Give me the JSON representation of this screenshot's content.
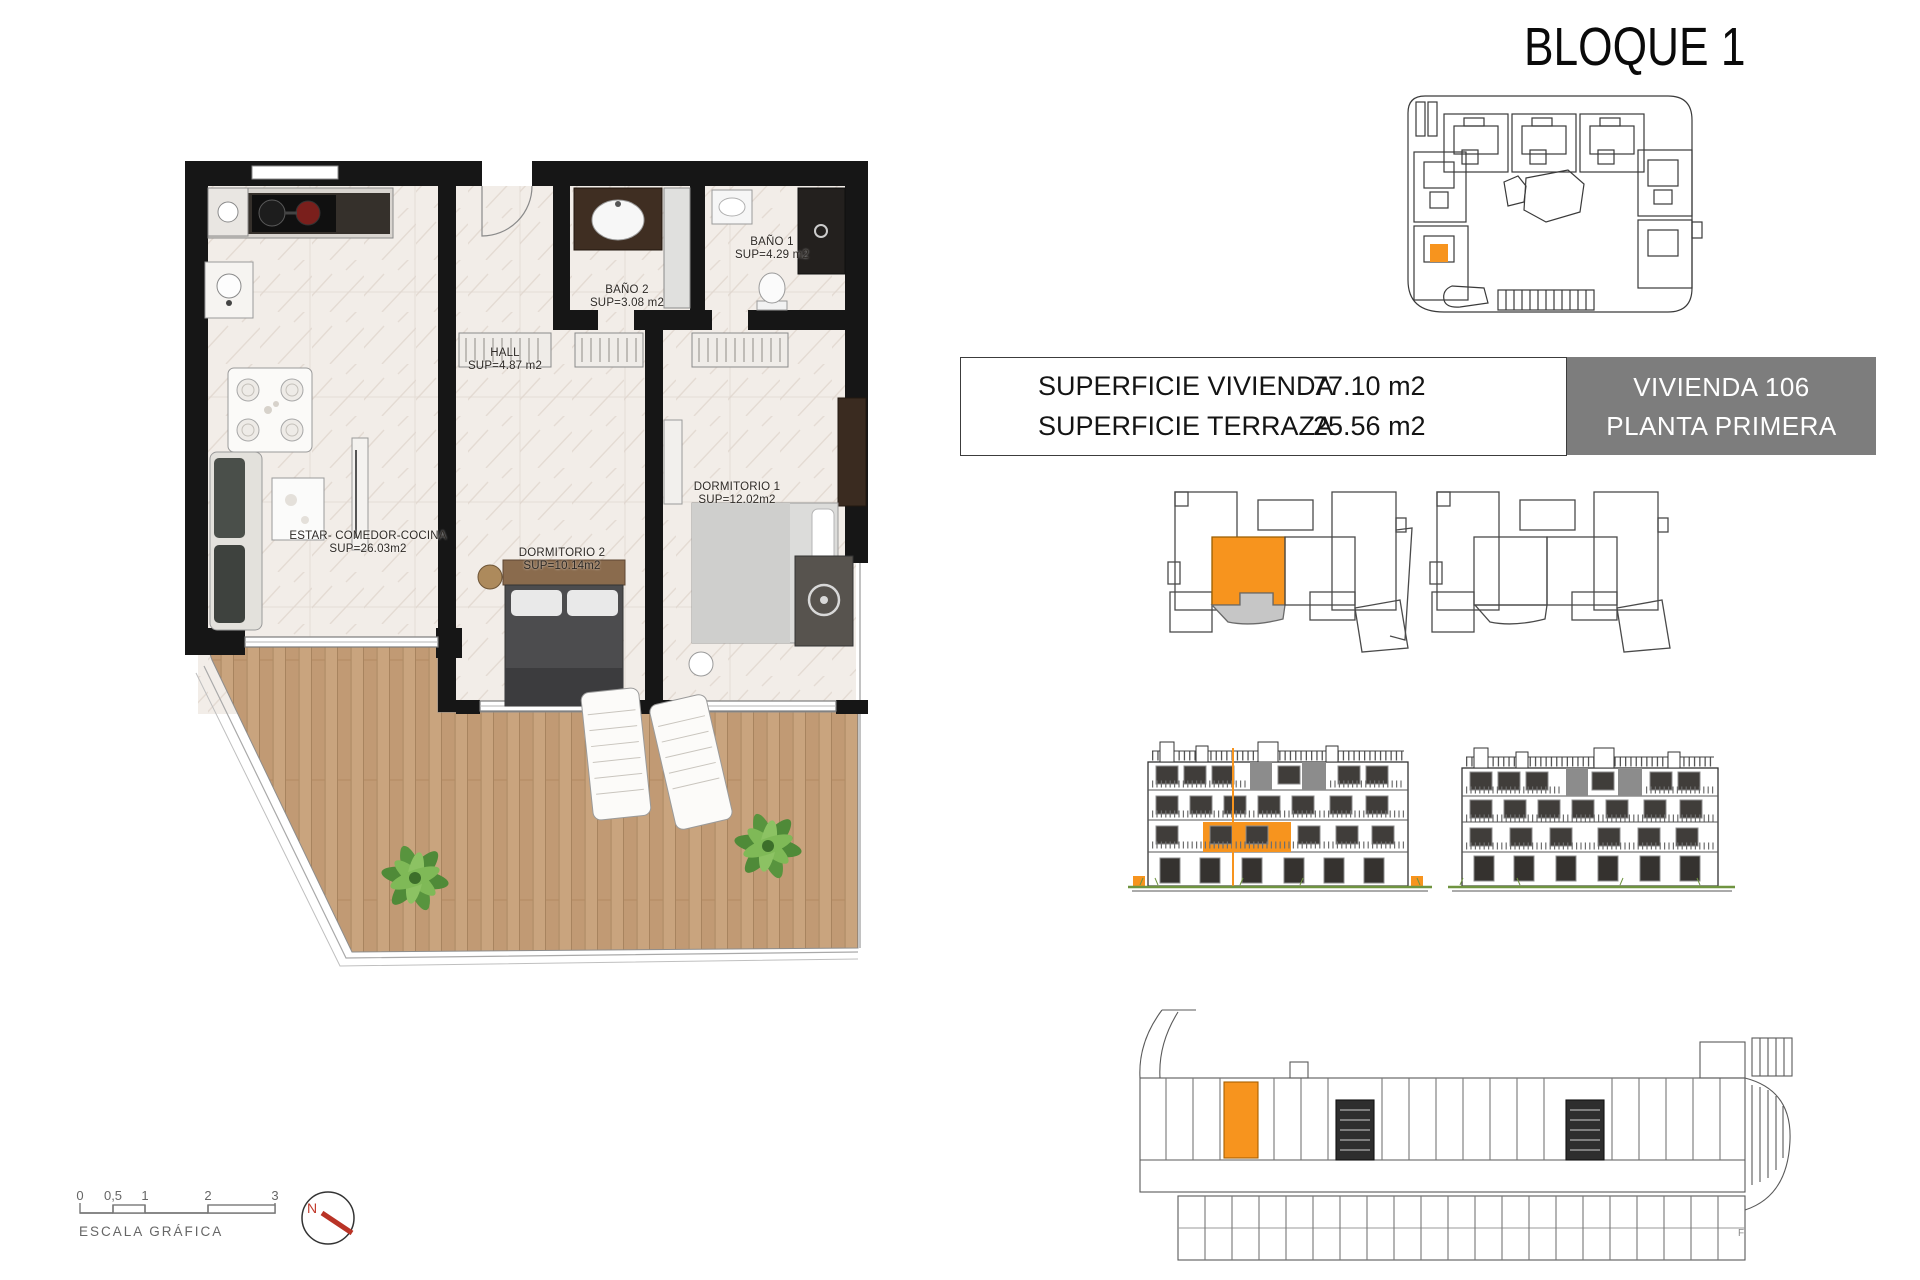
{
  "title": "BLOQUE 1",
  "info_panel": {
    "rows": [
      {
        "label": "SUPERFICIE VIVIENDA",
        "value": "77.10 m2"
      },
      {
        "label": "SUPERFICIE TERRAZA",
        "value": "25.56 m2"
      }
    ]
  },
  "unit_badge": {
    "line1": "VIVIENDA 106",
    "line2": "PLANTA PRIMERA"
  },
  "floor_plan": {
    "rooms": [
      {
        "name": "ESTAR-  COMEDOR-COCINA",
        "area": "SUP=26.03m2"
      },
      {
        "name": "HALL",
        "area": "SUP=4.87  m2"
      },
      {
        "name": "BAÑO 2",
        "area": "SUP=3.08  m2"
      },
      {
        "name": "BAÑO 1",
        "area": "SUP=4.29  m2"
      },
      {
        "name": "DORMITORIO  1",
        "area": "SUP=12.02m2"
      },
      {
        "name": "DORMITORIO  2",
        "area": "SUP=10.14m2"
      }
    ]
  },
  "scale_bar": {
    "ticks": [
      "0",
      "0,5",
      "1",
      "2",
      "3"
    ],
    "label": "ESCALA GRÁFICA"
  },
  "compass": {
    "north_label": "N"
  },
  "footnote": "F",
  "colors": {
    "accent_orange": "#F7941E",
    "badge_gray": "#7D7D7D",
    "terrace_gray": "#C6C6C6",
    "wood": "#C9A47E",
    "wall_black": "#161616",
    "ground_green": "#6F9440"
  }
}
